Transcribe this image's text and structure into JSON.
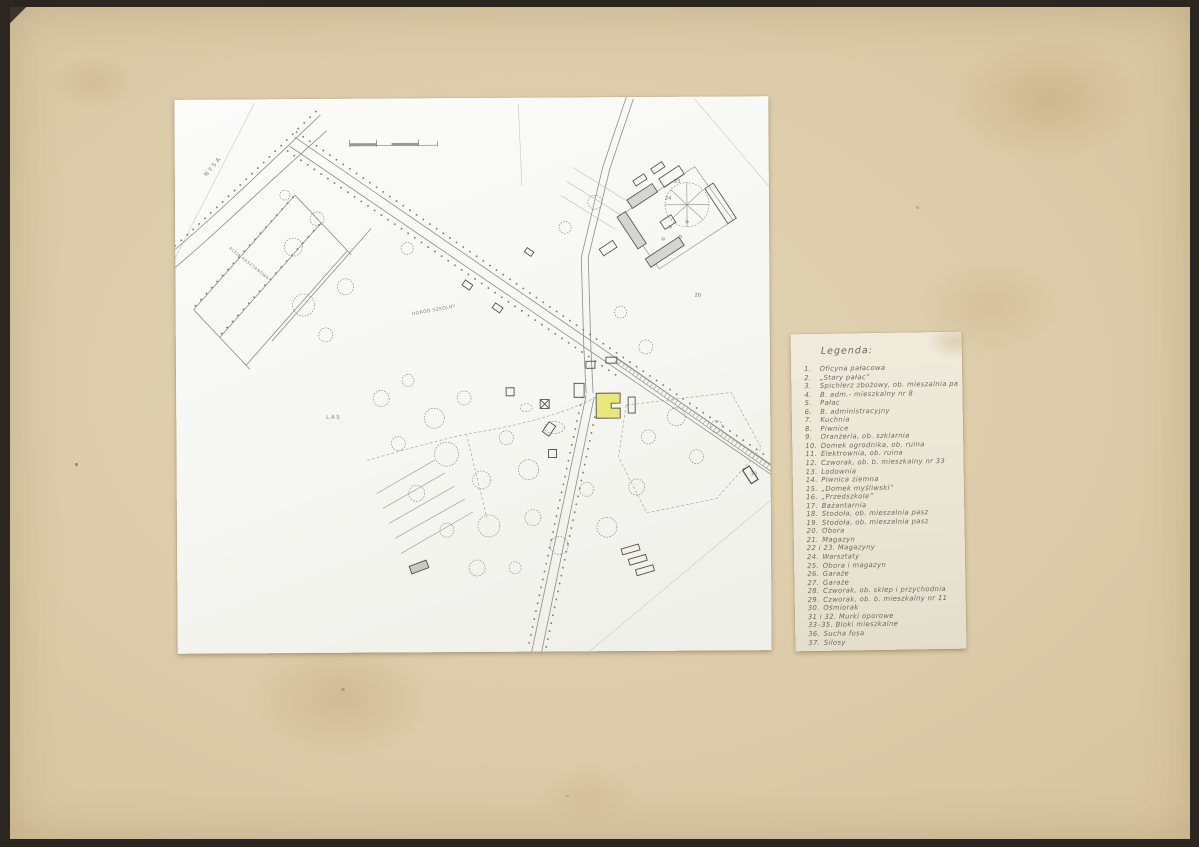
{
  "colors": {
    "scan_edge": "#2b2620",
    "cardboard": "#d8c6a1",
    "cardboard_light": "#e2d4b5",
    "map_paper": "#f6f6f2",
    "legend_paper": "#eae4d3",
    "pencil": "#8e8e88",
    "pencil_dark": "#5c5b55",
    "handwriting": "#6e6961",
    "highlight_yellow": "#e9e77c"
  },
  "map": {
    "text_labels": [
      {
        "id": "road-nysa",
        "text": "NYSA",
        "x": 28,
        "y": 74,
        "rot": -50,
        "size": 6,
        "ls": 2
      },
      {
        "id": "avenue",
        "text": "ALEJA KASZTANOWA",
        "x": 56,
        "y": 146,
        "rot": 39,
        "size": 4,
        "ls": 0.6
      },
      {
        "id": "school-garden",
        "text": "OGRÓD SZKOLNY",
        "x": 236,
        "y": 214,
        "rot": -10,
        "size": 4.5,
        "ls": 0.4
      },
      {
        "id": "forest",
        "text": "LAS",
        "x": 150,
        "y": 316,
        "rot": 0,
        "size": 5.5,
        "ls": 1.5
      }
    ],
    "building_numbers": [
      {
        "text": "23",
        "x": 499,
        "y": 82
      },
      {
        "text": "24",
        "x": 490,
        "y": 99
      },
      {
        "text": "20",
        "x": 519,
        "y": 196
      },
      {
        "text": "30",
        "x": 574,
        "y": 375
      }
    ]
  },
  "legend": {
    "title": "Legenda:",
    "items": [
      {
        "no": "1.",
        "label": "Oficyna pałacowa"
      },
      {
        "no": "2.",
        "label": "„Stary pałac”"
      },
      {
        "no": "3.",
        "label": "Spichlerz zbożowy, ob. mieszalnia pasz"
      },
      {
        "no": "4.",
        "label": "B. adm.- mieszkalny nr 8"
      },
      {
        "no": "5.",
        "label": "Pałac"
      },
      {
        "no": "6.",
        "label": "B. administracyjny"
      },
      {
        "no": "7.",
        "label": "Kuchnia"
      },
      {
        "no": "8.",
        "label": "Piwnice"
      },
      {
        "no": "9.",
        "label": "Oranżeria, ob. szklarnia"
      },
      {
        "no": "10.",
        "label": "Domek ogrodnika, ob. ruina"
      },
      {
        "no": "11.",
        "label": "Elektrownia, ob. ruina"
      },
      {
        "no": "12.",
        "label": "Czworak, ob. b. mieszkalny nr 33"
      },
      {
        "no": "13.",
        "label": "Lodownia"
      },
      {
        "no": "14.",
        "label": "Piwnica ziemna"
      },
      {
        "no": "15.",
        "label": "„Domek myśliwski”"
      },
      {
        "no": "16.",
        "label": "„Przedszkole”"
      },
      {
        "no": "17.",
        "label": "Bażantarnia"
      },
      {
        "no": "18.",
        "label": "Stodoła, ob. mieszalnia pasz"
      },
      {
        "no": "19.",
        "label": "Stodoła, ob. mieszalnia pasz"
      },
      {
        "no": "20.",
        "label": "Obora"
      },
      {
        "no": "21.",
        "label": "Magazyn"
      },
      {
        "no": "22 i 23.",
        "label": "Magazyny"
      },
      {
        "no": "24.",
        "label": "Warsztaty"
      },
      {
        "no": "25.",
        "label": "Obora i magazyn"
      },
      {
        "no": "26.",
        "label": "Garaże"
      },
      {
        "no": "27.",
        "label": "Garaże"
      },
      {
        "no": "28.",
        "label": "Czworak, ob. sklep i przychodnia"
      },
      {
        "no": "29.",
        "label": "Czworak, ob. b. mieszkalny nr 11"
      },
      {
        "no": "30.",
        "label": "Ośmiorak"
      },
      {
        "no": "31 i 32.",
        "label": "Murki oporowe"
      },
      {
        "no": "33–35.",
        "label": "Bloki mieszkalne"
      },
      {
        "no": "36.",
        "label": "Sucha fosa"
      },
      {
        "no": "37.",
        "label": "Silosy"
      }
    ]
  }
}
